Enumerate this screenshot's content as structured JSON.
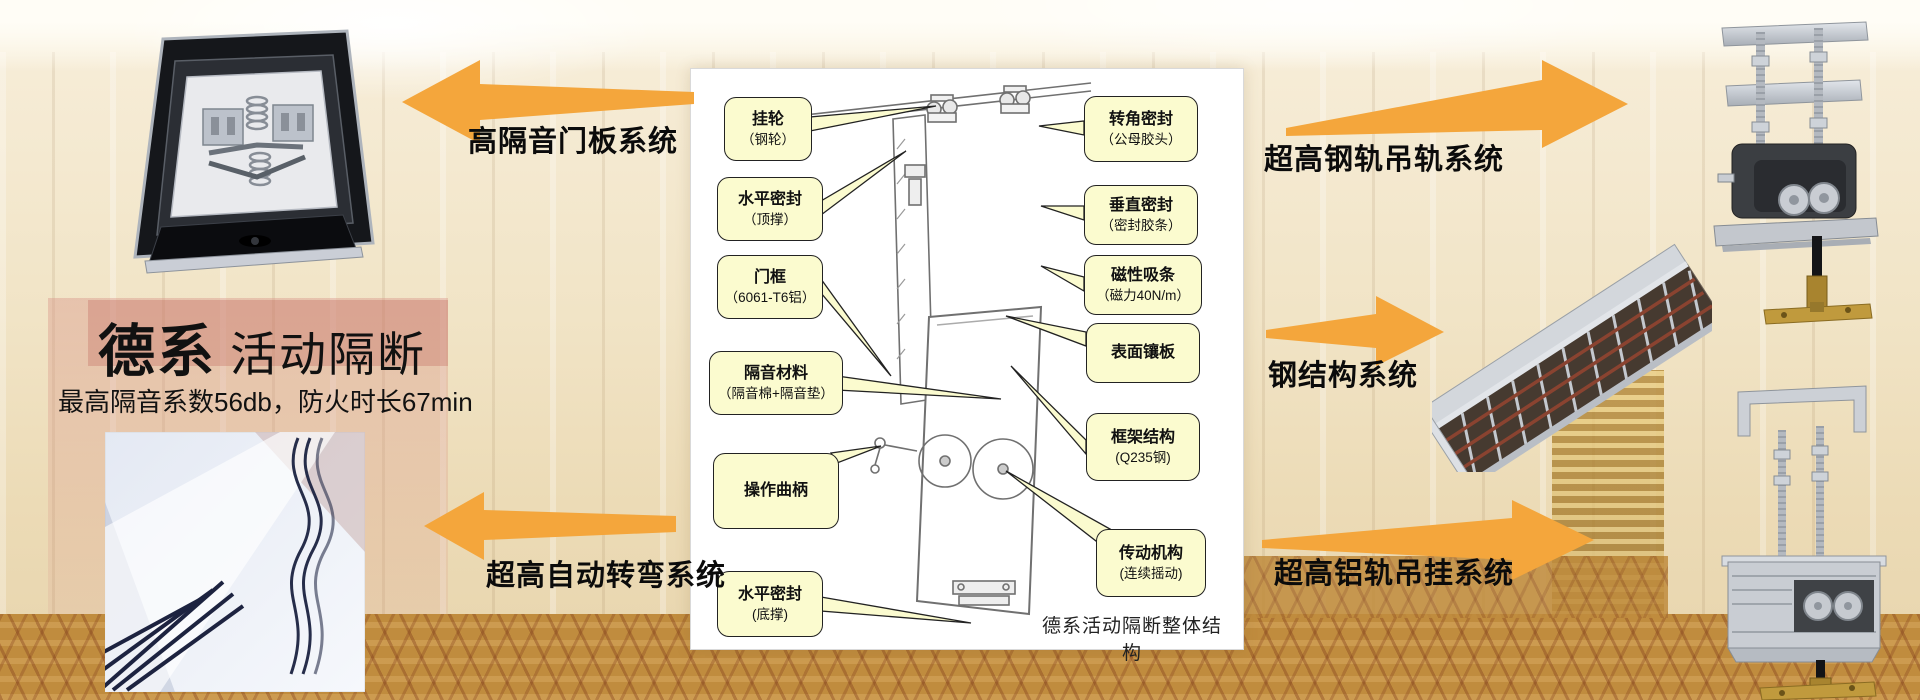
{
  "hero": {
    "title_bold": "德系",
    "title_regular": "活动隔断",
    "subtitle": "最高隔音系数56db，防火时长67min"
  },
  "callout_arrows": {
    "door_panel": "高隔音门板系统",
    "auto_turning": "超高自动转弯系统",
    "steel_rail": "超高钢轨吊轨系统",
    "steel_structure": "钢结构系统",
    "aluminum_rail": "超高铝轨吊挂系统"
  },
  "diagram": {
    "caption": "德系活动隔断整体结构",
    "labels_left": [
      {
        "line1": "挂轮",
        "line2": "（钢轮）"
      },
      {
        "line1": "水平密封",
        "line2": "（顶撑）"
      },
      {
        "line1": "门框",
        "line2": "（6061-T6铝）"
      },
      {
        "line1": "隔音材料",
        "line2": "（隔音棉+隔音垫）"
      },
      {
        "line1": "操作曲柄",
        "line2": ""
      },
      {
        "line1": "水平密封",
        "line2": "(底撑)"
      }
    ],
    "labels_right": [
      {
        "line1": "转角密封",
        "line2": "（公母胶头）"
      },
      {
        "line1": "垂直密封",
        "line2": "（密封胶条）"
      },
      {
        "line1": "磁性吸条",
        "line2": "（磁力40N/m）"
      },
      {
        "line1": "表面镶板",
        "line2": ""
      },
      {
        "line1": "框架结构",
        "line2": "(Q235钢)"
      },
      {
        "line1": "传动机构",
        "line2": "(连续摇动)"
      }
    ]
  },
  "photos": {
    "top_left": "partition-head-mechanism-photo",
    "bottom_left": "curved-track-photo",
    "top_right": "steel-rail-carrier-photo",
    "middle_right": "steel-structure-photo",
    "bottom_right": "aluminum-rail-carrier-photo"
  },
  "colors": {
    "arrow_orange": "#F4A63C",
    "callout_fill": "#FBFBCF",
    "callout_border": "#222222",
    "background_cream": "#F0E2C6",
    "carpet_gold": "#C08D3F"
  }
}
